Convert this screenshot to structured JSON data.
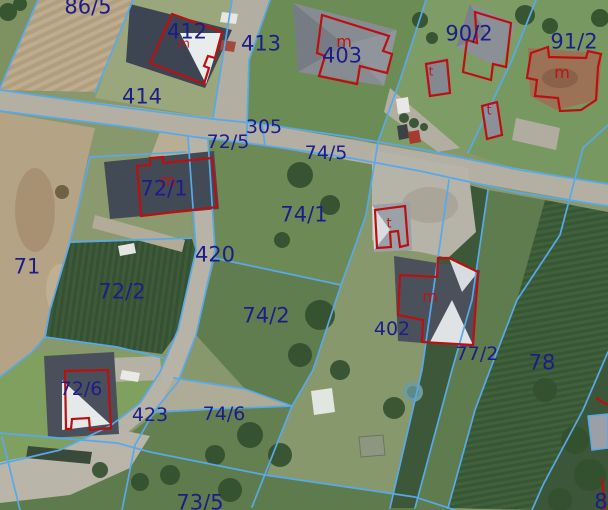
{
  "map": {
    "colors": {
      "parcel_line": "#58a9ea",
      "building_outline": "#bb1010",
      "parcel_label": "#1d1d8a",
      "building_letter": "#c01212"
    },
    "parcel_labels": [
      {
        "text": "86/5",
        "cx": 88,
        "cy": 6,
        "s": 21
      },
      {
        "text": "412",
        "cx": 187,
        "cy": 31,
        "s": 21
      },
      {
        "text": "413",
        "cx": 261,
        "cy": 43,
        "s": 21
      },
      {
        "text": "403",
        "cx": 342,
        "cy": 55,
        "s": 21
      },
      {
        "text": "90/2",
        "cx": 469,
        "cy": 33,
        "s": 21
      },
      {
        "text": "91/2",
        "cx": 574,
        "cy": 41,
        "s": 21
      },
      {
        "text": "414",
        "cx": 142,
        "cy": 96,
        "s": 21
      },
      {
        "text": "305",
        "cx": 264,
        "cy": 126,
        "s": 19
      },
      {
        "text": "72/5",
        "cx": 228,
        "cy": 141,
        "s": 19
      },
      {
        "text": "74/5",
        "cx": 326,
        "cy": 152,
        "s": 19
      },
      {
        "text": "72/1",
        "cx": 164,
        "cy": 188,
        "s": 21
      },
      {
        "text": "74/1",
        "cx": 304,
        "cy": 214,
        "s": 21
      },
      {
        "text": "71",
        "cx": 27,
        "cy": 266,
        "s": 21
      },
      {
        "text": "72/2",
        "cx": 122,
        "cy": 291,
        "s": 21
      },
      {
        "text": "420",
        "cx": 215,
        "cy": 254,
        "s": 21
      },
      {
        "text": "74/2",
        "cx": 266,
        "cy": 315,
        "s": 21
      },
      {
        "text": "402",
        "cx": 392,
        "cy": 328,
        "s": 19
      },
      {
        "text": "77/2",
        "cx": 477,
        "cy": 353,
        "s": 19
      },
      {
        "text": "78",
        "cx": 542,
        "cy": 362,
        "s": 21
      },
      {
        "text": "72/6",
        "cx": 81,
        "cy": 388,
        "s": 19
      },
      {
        "text": "423",
        "cx": 150,
        "cy": 414,
        "s": 19
      },
      {
        "text": "74/6",
        "cx": 224,
        "cy": 413,
        "s": 19
      },
      {
        "text": "73/5",
        "cx": 200,
        "cy": 502,
        "s": 21
      },
      {
        "text": "8",
        "cx": 601,
        "cy": 501,
        "s": 21
      }
    ],
    "building_labels": [
      {
        "text": "m",
        "cx": 184,
        "cy": 43,
        "s": 12
      },
      {
        "text": "m",
        "cx": 344,
        "cy": 41,
        "s": 16
      },
      {
        "text": "t",
        "cx": 431,
        "cy": 71,
        "s": 12
      },
      {
        "text": "t",
        "cx": 489,
        "cy": 110,
        "s": 13
      },
      {
        "text": "m",
        "cx": 562,
        "cy": 72,
        "s": 16
      },
      {
        "text": "m",
        "cx": 168,
        "cy": 180,
        "s": 16
      },
      {
        "text": "t",
        "cx": 389,
        "cy": 223,
        "s": 13
      },
      {
        "text": "m",
        "cx": 430,
        "cy": 296,
        "s": 16
      }
    ],
    "parcel_lines": [
      {
        "points": [
          [
            38,
            0
          ],
          [
            0,
            88
          ]
        ]
      },
      {
        "points": [
          [
            133,
            0
          ],
          [
            95,
            93
          ]
        ]
      },
      {
        "points": [
          [
            232,
            0
          ],
          [
            213,
            118
          ]
        ]
      },
      {
        "points": [
          [
            270,
            0
          ],
          [
            249,
            60
          ],
          [
            247,
            127
          ]
        ]
      },
      {
        "points": [
          [
            426,
            0
          ],
          [
            400,
            80
          ],
          [
            378,
            142
          ]
        ]
      },
      {
        "points": [
          [
            536,
            0
          ],
          [
            512,
            60
          ],
          [
            468,
            153
          ]
        ]
      },
      {
        "points": [
          [
            0,
            90
          ],
          [
            120,
            107
          ],
          [
            213,
            119
          ],
          [
            262,
            124
          ],
          [
            350,
            137
          ],
          [
            420,
            149
          ],
          [
            520,
            170
          ],
          [
            608,
            184
          ]
        ]
      },
      {
        "points": [
          [
            0,
            111
          ],
          [
            120,
            126
          ],
          [
            195,
            137
          ],
          [
            262,
            145
          ],
          [
            350,
            158
          ],
          [
            420,
            171
          ],
          [
            520,
            193
          ],
          [
            608,
            206
          ]
        ]
      },
      {
        "points": [
          [
            262,
            124
          ],
          [
            265,
            145
          ]
        ]
      },
      {
        "points": [
          [
            247,
            127
          ],
          [
            246,
            146
          ]
        ]
      },
      {
        "points": [
          [
            188,
            137
          ],
          [
            196,
            250
          ],
          [
            178,
            330
          ],
          [
            160,
            372
          ],
          [
            140,
            403
          ],
          [
            110,
            426
          ],
          [
            60,
            450
          ],
          [
            0,
            464
          ]
        ]
      },
      {
        "points": [
          [
            208,
            140
          ],
          [
            215,
            250
          ],
          [
            196,
            335
          ],
          [
            178,
            382
          ],
          [
            155,
            410
          ],
          [
            135,
            445
          ],
          [
            122,
            510
          ]
        ]
      },
      {
        "points": [
          [
            2,
            437
          ],
          [
            20,
            510
          ]
        ]
      },
      {
        "points": [
          [
            0,
            433
          ],
          [
            117,
            443
          ],
          [
            150,
            452
          ],
          [
            265,
            475
          ],
          [
            415,
            497
          ],
          [
            455,
            510
          ]
        ]
      },
      {
        "points": [
          [
            90,
            157
          ],
          [
            186,
            152
          ]
        ]
      },
      {
        "points": [
          [
            90,
            157
          ],
          [
            70,
            242
          ]
        ]
      },
      {
        "points": [
          [
            70,
            242
          ],
          [
            192,
            238
          ]
        ]
      },
      {
        "points": [
          [
            70,
            242
          ],
          [
            50,
            310
          ],
          [
            45,
            337
          ]
        ]
      },
      {
        "points": [
          [
            45,
            337
          ],
          [
            117,
            347
          ],
          [
            163,
            358
          ]
        ]
      },
      {
        "points": [
          [
            45,
            337
          ],
          [
            32,
            352
          ],
          [
            0,
            377
          ]
        ]
      },
      {
        "points": [
          [
            174,
            378
          ],
          [
            245,
            389
          ],
          [
            292,
            406
          ]
        ]
      },
      {
        "points": [
          [
            155,
            412
          ],
          [
            215,
            409
          ],
          [
            292,
            406
          ]
        ]
      },
      {
        "points": [
          [
            378,
            142
          ],
          [
            366,
            215
          ],
          [
            358,
            238
          ],
          [
            341,
            285
          ],
          [
            313,
            370
          ],
          [
            292,
            406
          ],
          [
            252,
            507
          ]
        ]
      },
      {
        "points": [
          [
            214,
            258
          ],
          [
            341,
            285
          ]
        ]
      },
      {
        "points": [
          [
            449,
            180
          ],
          [
            432,
            300
          ],
          [
            422,
            370
          ],
          [
            390,
            508
          ]
        ]
      },
      {
        "points": [
          [
            488,
            190
          ],
          [
            472,
            300
          ],
          [
            452,
            370
          ],
          [
            415,
            508
          ]
        ]
      },
      {
        "points": [
          [
            608,
            125
          ],
          [
            583,
            148
          ],
          [
            560,
            235
          ],
          [
            517,
            300
          ],
          [
            490,
            370
          ],
          [
            475,
            410
          ],
          [
            448,
            508
          ]
        ]
      },
      {
        "points": [
          [
            608,
            352
          ],
          [
            583,
            410
          ],
          [
            543,
            485
          ],
          [
            532,
            510
          ]
        ]
      }
    ],
    "building_outlines": [
      {
        "closed": true,
        "points": [
          [
            172,
            14
          ],
          [
            222,
            32
          ],
          [
            215,
            58
          ],
          [
            208,
            56
          ],
          [
            204,
            66
          ],
          [
            209,
            68
          ],
          [
            204,
            84
          ],
          [
            150,
            63
          ]
        ]
      },
      {
        "closed": true,
        "points": [
          [
            322,
            15
          ],
          [
            389,
            36
          ],
          [
            383,
            51
          ],
          [
            392,
            54
          ],
          [
            387,
            73
          ],
          [
            360,
            66
          ],
          [
            357,
            84
          ],
          [
            319,
            76
          ],
          [
            325,
            56
          ],
          [
            317,
            53
          ]
        ]
      },
      {
        "closed": true,
        "points": [
          [
            475,
            12
          ],
          [
            511,
            23
          ],
          [
            506,
            67
          ],
          [
            493,
            64
          ],
          [
            491,
            80
          ],
          [
            463,
            72
          ],
          [
            467,
            40
          ],
          [
            477,
            43
          ]
        ]
      },
      {
        "closed": true,
        "points": [
          [
            426,
            64
          ],
          [
            447,
            60
          ],
          [
            450,
            93
          ],
          [
            430,
            96
          ]
        ]
      },
      {
        "closed": true,
        "points": [
          [
            482,
            106
          ],
          [
            497,
            102
          ],
          [
            502,
            135
          ],
          [
            487,
            139
          ]
        ]
      },
      {
        "closed": true,
        "points": [
          [
            531,
            53
          ],
          [
            548,
            47
          ],
          [
            549,
            57
          ],
          [
            586,
            58
          ],
          [
            588,
            51
          ],
          [
            601,
            54
          ],
          [
            598,
            67
          ],
          [
            596,
            100
          ],
          [
            581,
            110
          ],
          [
            560,
            111
          ],
          [
            558,
            98
          ],
          [
            535,
            96
          ],
          [
            537,
            80
          ],
          [
            527,
            78
          ]
        ]
      },
      {
        "closed": true,
        "points": [
          [
            137,
            166
          ],
          [
            150,
            165
          ],
          [
            150,
            158
          ],
          [
            163,
            157
          ],
          [
            163,
            163
          ],
          [
            212,
            158
          ],
          [
            217,
            207
          ],
          [
            141,
            216
          ]
        ]
      },
      {
        "closed": true,
        "points": [
          [
            449,
            258
          ],
          [
            478,
            272
          ],
          [
            473,
            345
          ],
          [
            422,
            342
          ],
          [
            423,
            320
          ],
          [
            398,
            315
          ],
          [
            400,
            275
          ],
          [
            437,
            277
          ],
          [
            438,
            258
          ]
        ]
      },
      {
        "closed": true,
        "points": [
          [
            375,
            210
          ],
          [
            405,
            206
          ],
          [
            408,
            245
          ],
          [
            400,
            247
          ],
          [
            398,
            231
          ],
          [
            390,
            232
          ],
          [
            391,
            247
          ],
          [
            377,
            248
          ]
        ]
      },
      {
        "closed": true,
        "points": [
          [
            65,
            371
          ],
          [
            108,
            370
          ],
          [
            111,
            428
          ],
          [
            90,
            430
          ],
          [
            89,
            418
          ],
          [
            72,
            419
          ],
          [
            71,
            429
          ],
          [
            66,
            429
          ]
        ]
      },
      {
        "closed": false,
        "points": [
          [
            596,
            398
          ],
          [
            608,
            405
          ]
        ]
      },
      {
        "closed": false,
        "points": [
          [
            602,
            478
          ],
          [
            605,
            510
          ]
        ]
      }
    ]
  }
}
